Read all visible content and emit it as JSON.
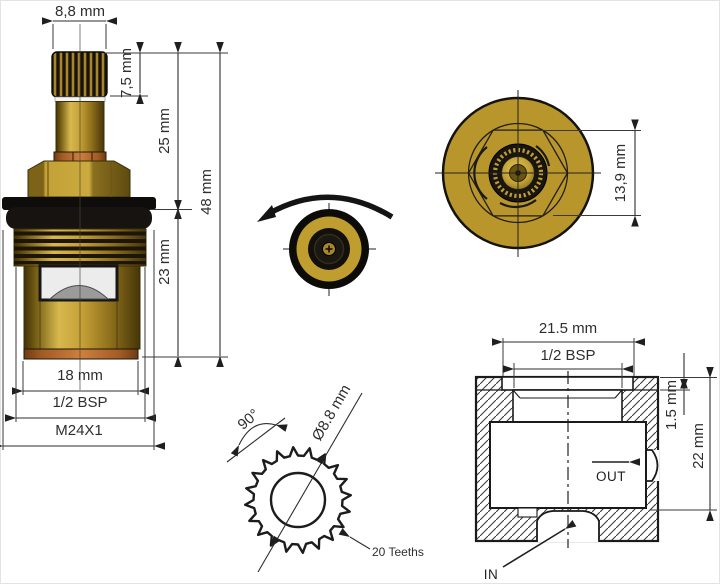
{
  "title": "Faucet valve cartridge technical drawing",
  "colors": {
    "brass_mid": "#c5a136",
    "brass_dark": "#6b5410",
    "gold_face": "#b8962c",
    "copper": "#b06a2e",
    "black_part": "#14110c",
    "line": "#2e2e2e"
  },
  "side_view": {
    "dims": {
      "stem_width": "8,8 mm",
      "spline_height": "7,5 mm",
      "upper_height": "25 mm",
      "total_height": "48 mm",
      "lower_height": "23 mm",
      "body_diameter": "18 mm",
      "thread": "1/2 BSP",
      "mount_thread": "M24X1"
    }
  },
  "top_view": {
    "dims": {
      "across_flats": "13,9 mm"
    }
  },
  "spline_detail": {
    "teeth_count": 20,
    "dims": {
      "angle": "90°",
      "diameter": "Ø8.8 mm",
      "teeth": "20 Teeths"
    }
  },
  "housing_section": {
    "dims": {
      "outer_width": "21.5 mm",
      "thread": "1/2 BSP",
      "step": "1.5 mm",
      "depth": "22 mm"
    },
    "labels": {
      "out": "OUT",
      "in": "IN"
    }
  }
}
